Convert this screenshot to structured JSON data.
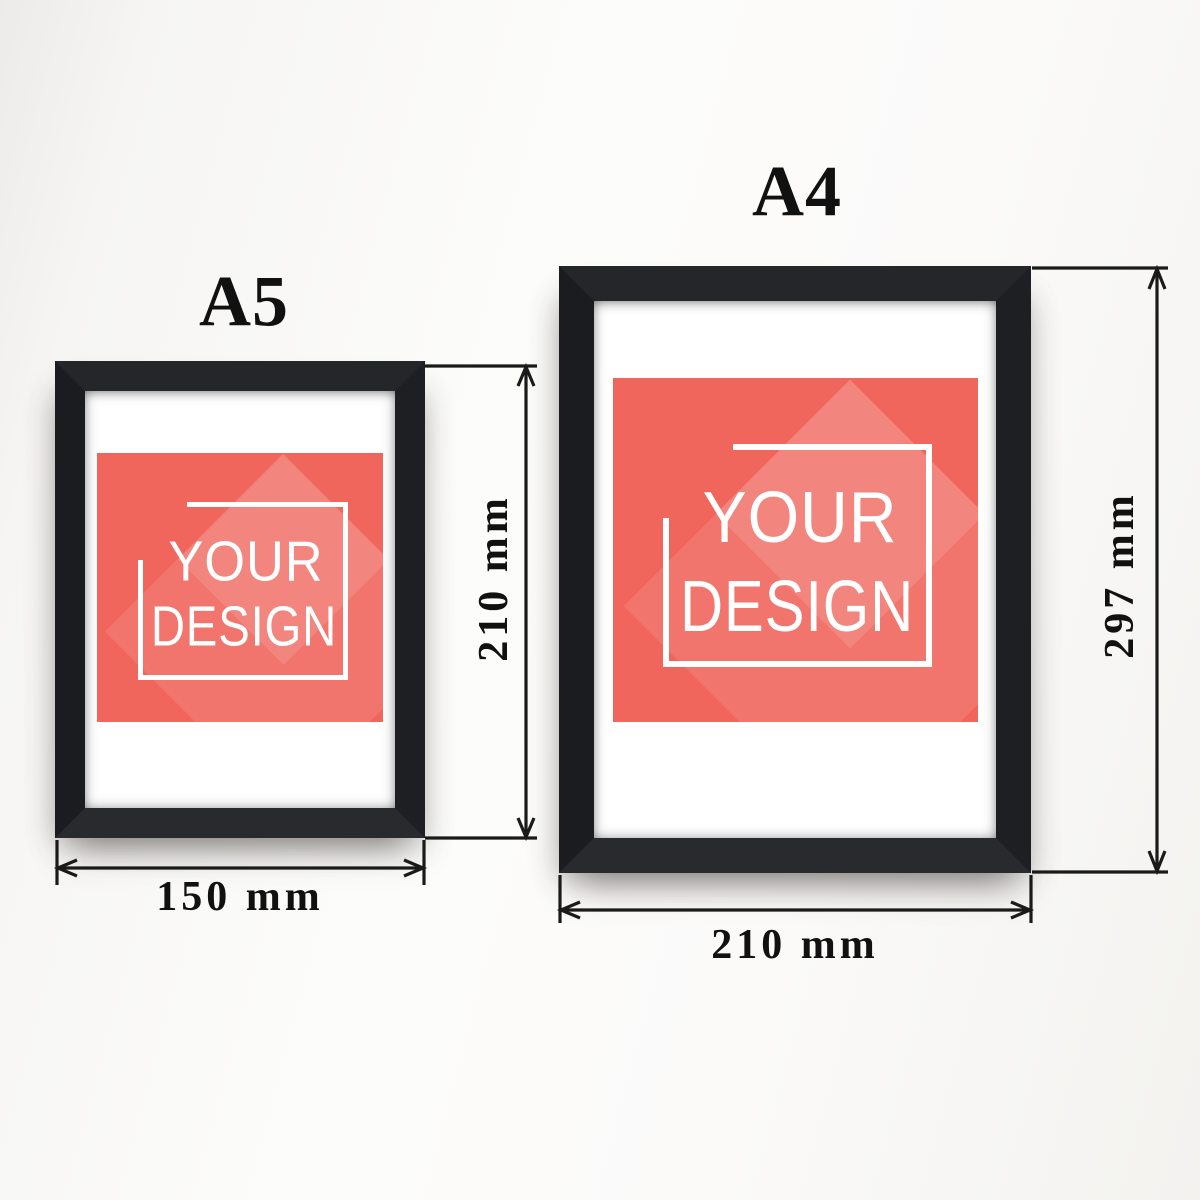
{
  "colors": {
    "wall": "#f6f5f3",
    "frame_black": "#1f2023",
    "mat_white": "#ffffff",
    "artwork_red": "#f0665c",
    "logo_white": "#ffffff",
    "dimension_ink": "#1a1a1a"
  },
  "frames": [
    {
      "size_label": "A5",
      "width_label": "150 mm",
      "height_label": "210 mm",
      "artwork": {
        "line1": "YOUR",
        "line2": "DESIGN"
      }
    },
    {
      "size_label": "A4",
      "width_label": "210 mm",
      "height_label": "297 mm",
      "artwork": {
        "line1": "YOUR",
        "line2": "DESIGN"
      }
    }
  ]
}
